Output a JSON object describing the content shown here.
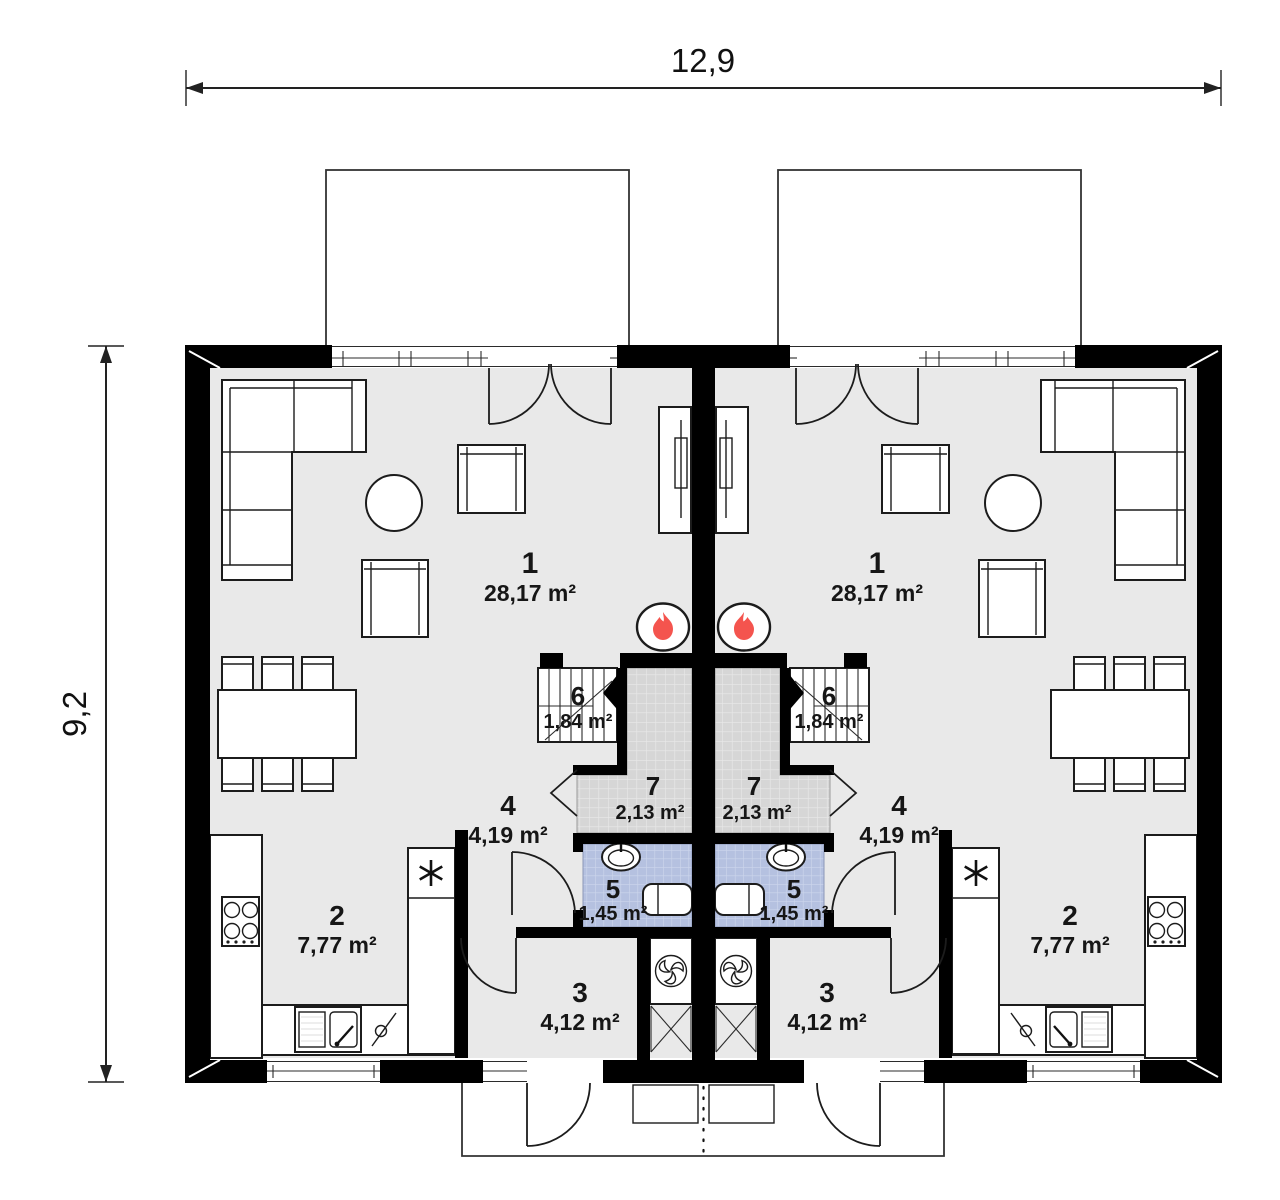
{
  "plan": {
    "type": "floor-plan",
    "description": "semi-detached duplex ground floor plan, two mirrored units",
    "dimensions": {
      "width": "12,9",
      "height": "9,2"
    },
    "rooms": [
      {
        "number": "1",
        "area": "28,17 m²"
      },
      {
        "number": "2",
        "area": "7,77 m²"
      },
      {
        "number": "3",
        "area": "4,12 m²"
      },
      {
        "number": "4",
        "area": "4,19 m²"
      },
      {
        "number": "5",
        "area": "1,45 m²"
      },
      {
        "number": "6",
        "area": "1,84 m²"
      },
      {
        "number": "7",
        "area": "2,13 m²"
      }
    ],
    "colors": {
      "wall": "#000000",
      "floor": "#e9e9e9",
      "hall_tile": "#d6d6d6",
      "bath_tile": "#b5c1e0",
      "accent_red": "#f4544e",
      "line": "#2b2b2b"
    },
    "icons": {
      "fireplace": "flame-icon",
      "ventilation": "fan-icon",
      "fridge": "asterisk-icon"
    }
  }
}
